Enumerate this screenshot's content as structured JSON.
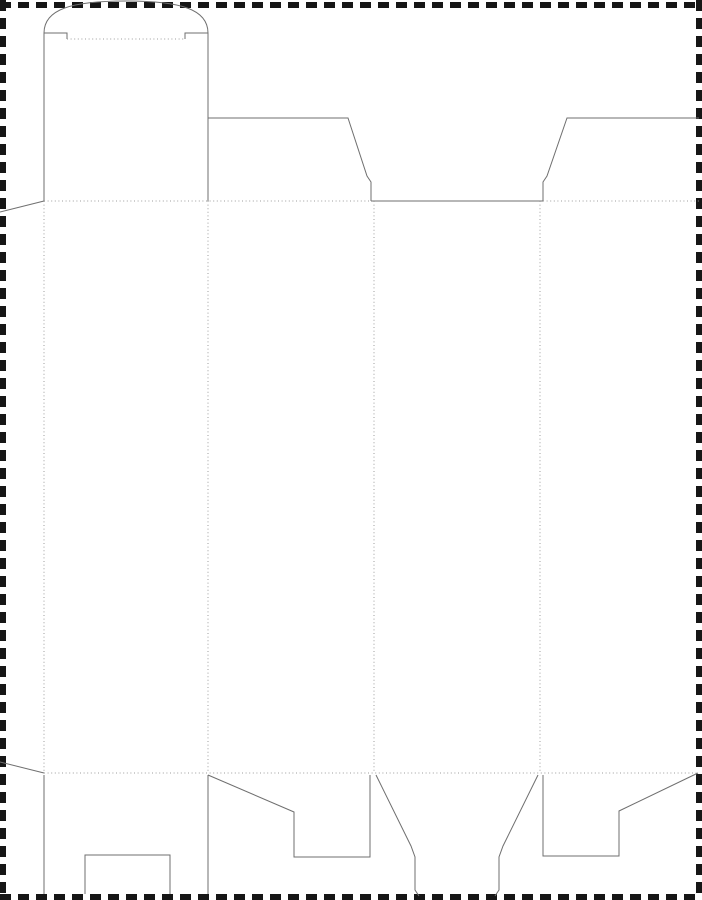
{
  "page": {
    "background_color": "#ffffff",
    "title": "carton-dieline-template"
  },
  "dieline": {
    "canvas": {
      "width": 702,
      "height": 900
    },
    "styles": {
      "border": {
        "color": "#161616",
        "width": 6,
        "dash": "11 7"
      },
      "cut": {
        "color": "#6f6f6f",
        "width": 1
      },
      "fold": {
        "color": "#9e9e9e",
        "width": 1,
        "dash": "1 2.6"
      }
    },
    "parts": [
      {
        "name": "page-border-top",
        "type": "border",
        "path": "M 0 5 L 702 5"
      },
      {
        "name": "page-border-left",
        "type": "border",
        "path": "M 3 0 L 3 900"
      },
      {
        "name": "page-border-right",
        "type": "border",
        "path": "M 699 0 L 699 900"
      },
      {
        "name": "page-border-bottom",
        "type": "border",
        "path": "M 0 897 L 702 897"
      },
      {
        "name": "tuck-flap-arc",
        "type": "cut",
        "path": "M 44 33 C 44 9 72 1 126 1 C 180 1 208 9 208 33"
      },
      {
        "name": "tuck-shoulder-left",
        "type": "cut",
        "path": "M 44 33 L 67 33 L 67 39"
      },
      {
        "name": "tuck-shoulder-right",
        "type": "cut",
        "path": "M 185 39 L 185 33 L 208 33"
      },
      {
        "name": "tuck-fold-line",
        "type": "fold",
        "path": "M 67 39 L 185 39"
      },
      {
        "name": "lid-panel-left-edge",
        "type": "cut",
        "path": "M 44 33 L 44 201"
      },
      {
        "name": "lid-panel-right-edge",
        "type": "cut",
        "path": "M 208 33 L 208 201"
      },
      {
        "name": "top-flap-2-outline",
        "type": "cut",
        "path": "M 208 118 L 348 118 L 367 176 L 371 182 L 371 201"
      },
      {
        "name": "panel-3-top-cut",
        "type": "cut",
        "path": "M 371 201 L 543 201"
      },
      {
        "name": "top-flap-4-outline",
        "type": "cut",
        "path": "M 543 201 L 543 182 L 547 176 L 567 118 L 699 118"
      },
      {
        "name": "glue-flap-top-edge",
        "type": "cut",
        "path": "M 0 212 L 44 201"
      },
      {
        "name": "glue-flap-bottom-edge",
        "type": "cut",
        "path": "M 0 762 L 44 773"
      },
      {
        "name": "fold-glue-flap",
        "type": "fold",
        "path": "M 44 201 L 44 773"
      },
      {
        "name": "fold-panel-1-2",
        "type": "fold",
        "path": "M 208 201 L 208 773"
      },
      {
        "name": "fold-panel-2-3",
        "type": "fold",
        "path": "M 374 201 L 374 773"
      },
      {
        "name": "fold-panel-3-4",
        "type": "fold",
        "path": "M 540 201 L 540 773"
      },
      {
        "name": "fold-top-left-span",
        "type": "fold",
        "path": "M 44 201 L 371 201"
      },
      {
        "name": "fold-top-right-span",
        "type": "fold",
        "path": "M 543 201 L 699 201"
      },
      {
        "name": "fold-bottom-span",
        "type": "fold",
        "path": "M 44 773 L 699 773"
      },
      {
        "name": "bottom-flap-1-left-edge",
        "type": "cut",
        "path": "M 44 775 L 44 894"
      },
      {
        "name": "bottom-flap-1-right-edge",
        "type": "cut",
        "path": "M 208 775 L 208 894"
      },
      {
        "name": "bottom-flap-1-notch",
        "type": "cut",
        "path": "M 85 894 L 85 855 L 170 855 L 170 894"
      },
      {
        "name": "bottom-flap-2-outline",
        "type": "cut",
        "path": "M 208 775 L 294 812 L 294 857 L 370 857 L 370 775"
      },
      {
        "name": "bottom-flap-3-left-edge",
        "type": "cut",
        "path": "M 376 775 L 411 846 L 415 857 L 415 890 L 419 896"
      },
      {
        "name": "bottom-flap-3-right-edge",
        "type": "cut",
        "path": "M 538 775 L 503 846 L 499 857 L 499 890 L 495 896"
      },
      {
        "name": "bottom-flap-4-outline",
        "type": "cut",
        "path": "M 543 775 L 543 856 L 619 856 L 619 811 L 698 773"
      }
    ]
  }
}
